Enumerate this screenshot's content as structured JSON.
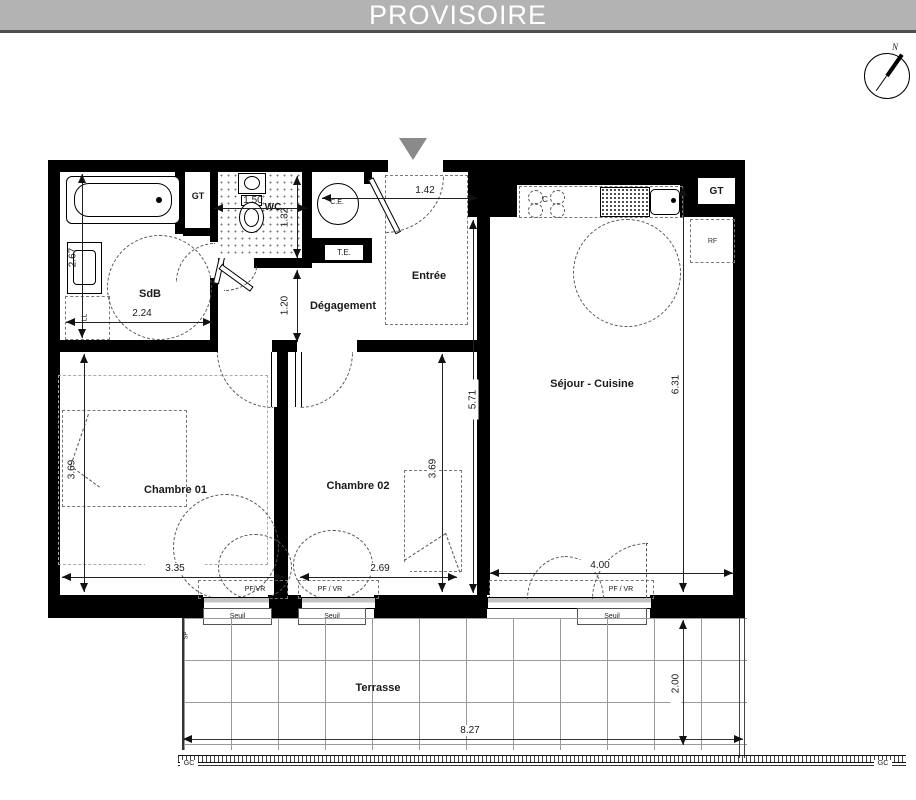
{
  "banner": {
    "title": "PROVISOIRE"
  },
  "compass": {
    "north": "N"
  },
  "rooms": {
    "sdb": "SdB",
    "wc": "WC",
    "degagement": "Dégagement",
    "entree": "Entrée",
    "chambre1": "Chambre 01",
    "chambre2": "Chambre 02",
    "sejour": "Séjour - Cuisine",
    "terrasse": "Terrasse"
  },
  "fixtures": {
    "gt_bath": "GT",
    "gt_kitchen": "GT",
    "water_heater": "C.E.",
    "electrical": "T.E.",
    "cooktop": "C",
    "fridge": "RF",
    "washer": "LL",
    "sp": "SP",
    "railing_left": "GC",
    "railing_right": "GC"
  },
  "openings": {
    "ch1_window": "PF/VR",
    "ch1_sill": "Seuil",
    "ch2_window": "PF / VR",
    "ch2_sill": "Seuil",
    "sejour_window": "PF / VR",
    "sejour_sill": "Seuil"
  },
  "dims": {
    "sdb_w": "2.24",
    "sdb_d": "2.67",
    "wc_w": "1.50",
    "wc_d": "1.32",
    "deg_w": "1.20",
    "entree_w": "1.42",
    "ch1_d": "3.69",
    "ch1_w": "3.35",
    "ch2_w": "2.69",
    "ch2_d": "3.69",
    "sejour_l": "5.71",
    "sejour_r": "6.31",
    "sejour_win": "4.00",
    "terr_w": "8.27",
    "terr_d": "2.00"
  }
}
